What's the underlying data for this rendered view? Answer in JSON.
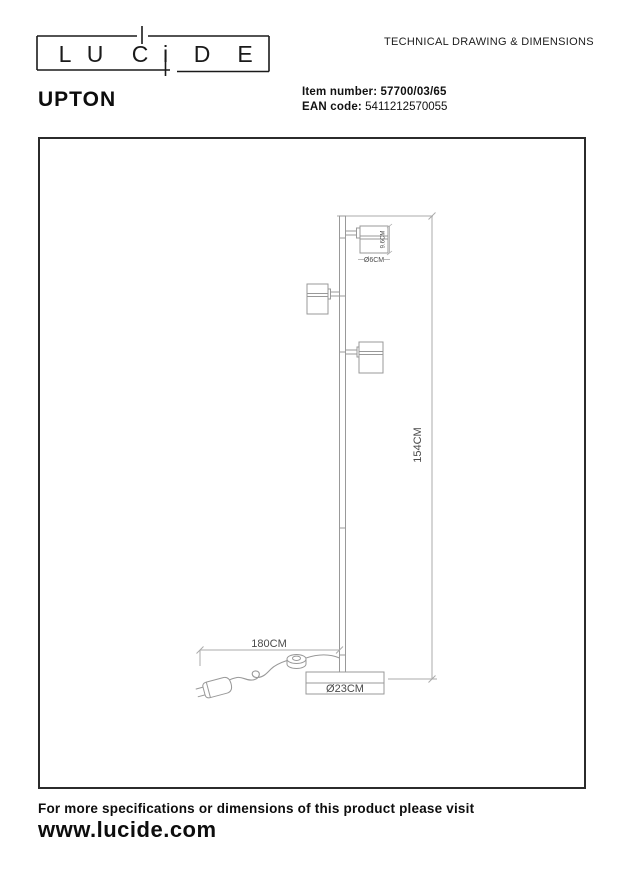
{
  "header": {
    "logo": {
      "brand": "LUCIDE",
      "letters": [
        "L",
        "U",
        "C",
        "i",
        "D",
        "E"
      ]
    },
    "doc_title": "TECHNICAL DRAWING & DIMENSIONS",
    "product_name": "UPTON",
    "item_number_label": "Item number:",
    "item_number_value": "57700/03/65",
    "ean_label": "EAN code:",
    "ean_value": "5411212570055"
  },
  "drawing": {
    "type": "floor-lamp technical drawing, side view, 3 spotlight heads on a pole with round base, cable with foot switch and plug",
    "dims": {
      "total_height": "154CM",
      "cable_length": "180CM",
      "base_diameter": "Ø23CM",
      "spot_diameter": "Ø6CM",
      "spot_height": "9.6CM"
    },
    "colors": {
      "frame": "#2b2b2b",
      "lamp_line": "#999999",
      "dim_line": "#aaaaaa",
      "dim_text": "#4a4a4a"
    }
  },
  "footer": {
    "note": "For more specifications or dimensions of this product please visit",
    "website": "www.lucide.com"
  }
}
